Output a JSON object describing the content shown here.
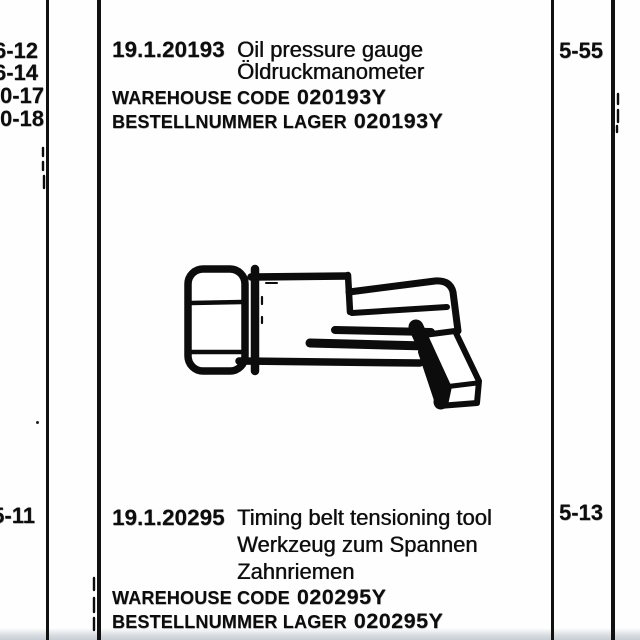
{
  "colors": {
    "paper": "#fefefe",
    "ink": "#0d0d0d",
    "scan_edge": "#c6cdd3"
  },
  "left_refs": [
    "6-12",
    "6-14",
    "0-17",
    "0-18"
  ],
  "left_ref_bottom": "5-11",
  "entries": [
    {
      "part_number": "19.1.20193",
      "name_en": "Oil pressure gauge",
      "name_de": [
        "Öldruckmanometer"
      ],
      "warehouse_label": "WAREHOUSE CODE",
      "warehouse_code": "020193Y",
      "bestell_label": "BESTELLNUMMER LAGER",
      "bestell_code": "020193Y",
      "page_ref": "5-55"
    },
    {
      "part_number": "19.1.20295",
      "name_en": "Timing belt tensioning tool",
      "name_de": [
        "Werkzeug zum Spannen",
        "Zahnriemen"
      ],
      "warehouse_label": "WAREHOUSE CODE",
      "warehouse_code": "020295Y",
      "bestell_label": "BESTELLNUMMER LAGER",
      "bestell_code": "020295Y",
      "page_ref": "5-13"
    }
  ],
  "illustration": {
    "name": "oil-pressure-gauge-adapter-line-drawing"
  }
}
